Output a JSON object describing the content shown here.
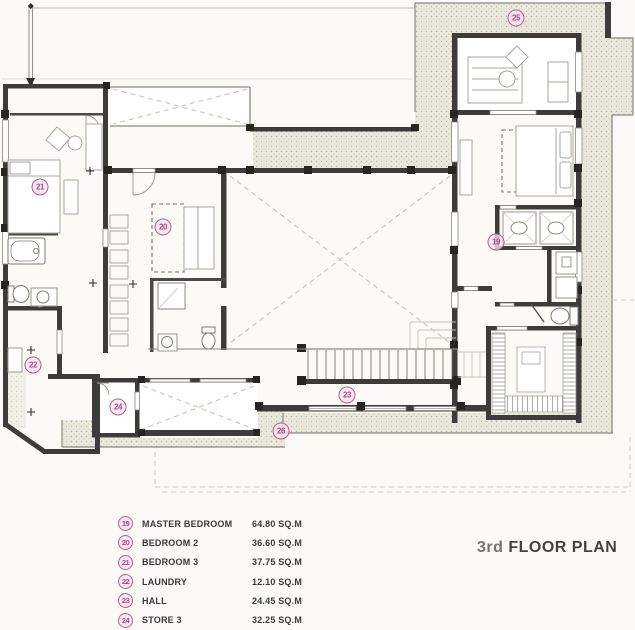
{
  "title": {
    "prefix": "3rd",
    "main": "FLOOR PLAN"
  },
  "legend": {
    "items": [
      {
        "number": "19",
        "label": "MASTER BEDROOM",
        "area": "64.80 SQ.M"
      },
      {
        "number": "20",
        "label": "BEDROOM 2",
        "area": "36.60 SQ.M"
      },
      {
        "number": "21",
        "label": "BEDROOM 3",
        "area": "37.75 SQ.M"
      },
      {
        "number": "22",
        "label": "LAUNDRY",
        "area": "12.10 SQ.M"
      },
      {
        "number": "23",
        "label": "HALL",
        "area": "24.45 SQ.M"
      },
      {
        "number": "24",
        "label": "STORE 3",
        "area": "32.25 SQ.M"
      }
    ]
  },
  "plan": {
    "markers": [
      {
        "number": "19"
      },
      {
        "number": "20"
      },
      {
        "number": "21"
      },
      {
        "number": "22"
      },
      {
        "number": "23"
      },
      {
        "number": "24"
      },
      {
        "number": "25"
      },
      {
        "number": "26"
      }
    ]
  },
  "colors": {
    "accent": "#c0588f",
    "wall": "#3d3c3a",
    "stipple_dot": "#b7b4a6"
  }
}
